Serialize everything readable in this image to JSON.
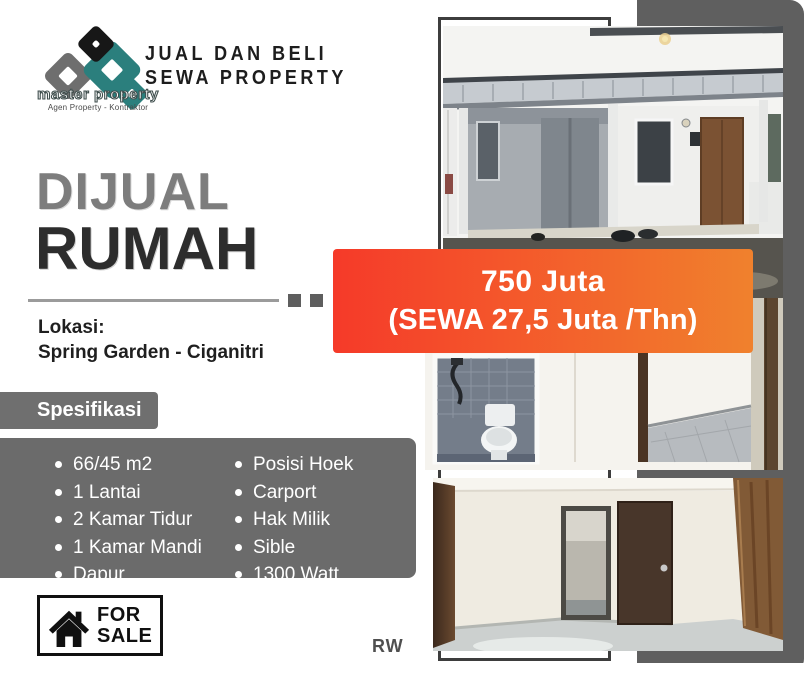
{
  "brand": {
    "logo_text": "master property",
    "logo_tagline": "Agen Property - Kontraktor",
    "header_line1": "JUAL DAN BELI",
    "header_line2": "SEWA PROPERTY"
  },
  "title": {
    "line1": "DIJUAL",
    "line2": "RUMAH"
  },
  "location": {
    "label": "Lokasi:",
    "value": "Spring Garden - Ciganitri"
  },
  "specs": {
    "heading": "Spesifikasi",
    "left": [
      "66/45 m2",
      "1 Lantai",
      "2 Kamar Tidur",
      "1 Kamar Mandi",
      "Dapur"
    ],
    "right": [
      "Posisi Hoek",
      "Carport",
      "Hak Milik",
      "Sible",
      "1300 Watt"
    ]
  },
  "price": {
    "line1": "750 Juta",
    "line2": "(SEWA 27,5 Juta /Thn)"
  },
  "sale_badge": {
    "line1": "FOR",
    "line2": "SALE"
  },
  "watermark": "RW",
  "photos": [
    {
      "name": "house-exterior-carport"
    },
    {
      "name": "bathroom-and-bedroom"
    },
    {
      "name": "interior-room-doors"
    }
  ],
  "colors": {
    "banner_red": "#f53a29",
    "banner_orange": "#f0812d",
    "charcoal_block": "#5f5f5f",
    "spec_gray": "#6b6b6b",
    "logo_teal": "#2b7f7d",
    "title_gray": "#7d7d7d",
    "title_dark": "#2d2d2d"
  }
}
